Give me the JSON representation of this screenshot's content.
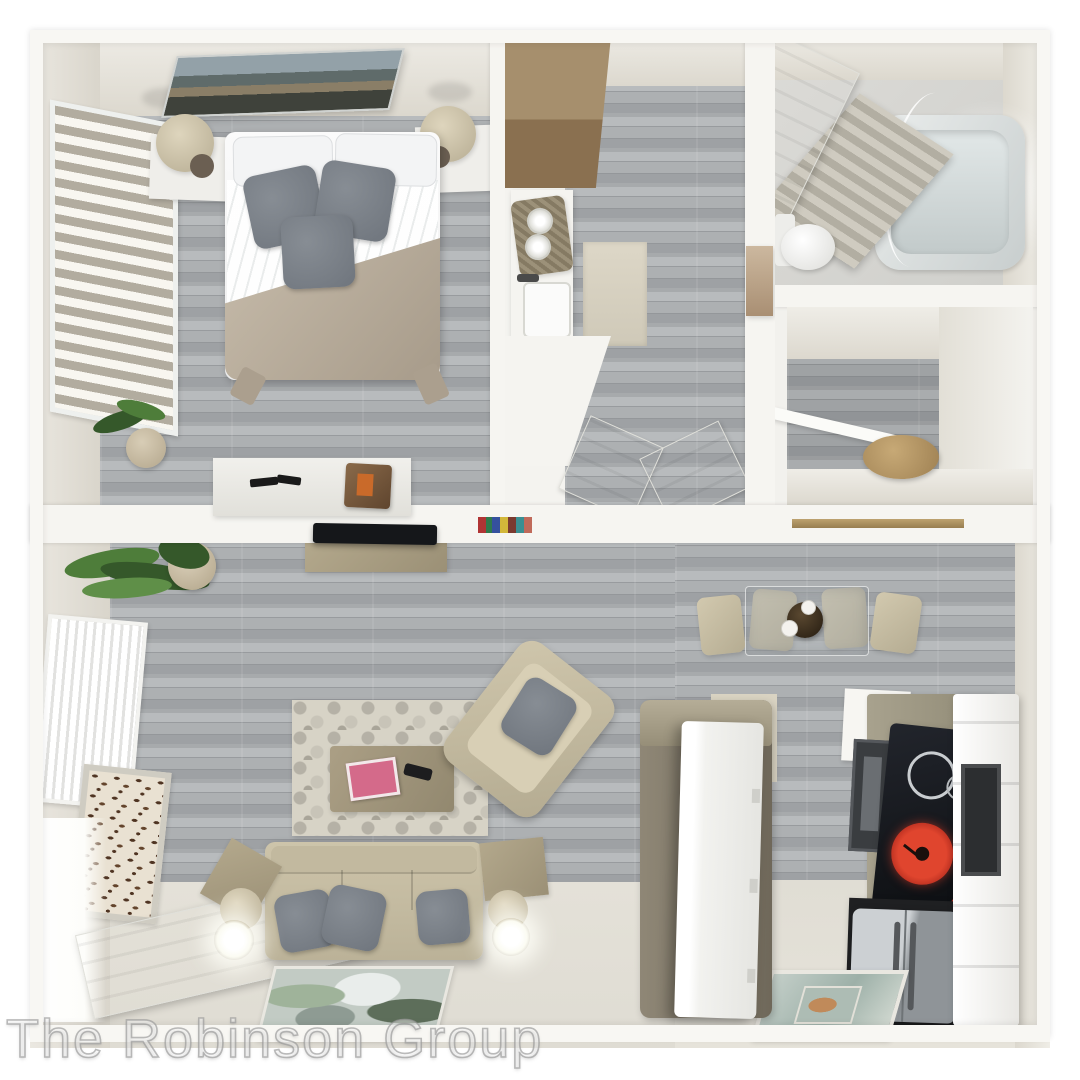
{
  "watermark": {
    "text": "The Robinson Group"
  },
  "scene": {
    "description": "3D top-down rendered floor plan of a one-bedroom apartment",
    "rooms": [
      {
        "name": "bedroom",
        "furniture": [
          "wall-art",
          "window-blinds",
          "nightstand-left",
          "lamp-left",
          "bed",
          "white-pillows",
          "gray-throw-pillows",
          "tan-blanket",
          "nightstand-right",
          "lamp-right",
          "potted-plant",
          "desk"
        ]
      },
      {
        "name": "laundry-closet",
        "furniture": [
          "wood-cabinet",
          "counter",
          "towel-tray",
          "sink"
        ]
      },
      {
        "name": "hallway",
        "furniture": [
          "runner-rug",
          "wall-painting",
          "open-door-left",
          "open-door-right"
        ]
      },
      {
        "name": "bathroom",
        "furniture": [
          "bathroom-door",
          "shower-curtain",
          "bathtub",
          "toilet"
        ]
      },
      {
        "name": "walk-in-closet",
        "furniture": [
          "shelves",
          "open-door",
          "basket"
        ]
      },
      {
        "name": "living-room",
        "furniture": [
          "hanging-plant",
          "potted-plant",
          "tv",
          "tv-console",
          "radiator",
          "leaf-artwork",
          "front-door",
          "area-rug",
          "coffee-table",
          "magazines",
          "remote-control",
          "armchair",
          "sofa",
          "sofa-pillows",
          "end-table-left",
          "floor-lamp-left",
          "end-table-right",
          "floor-lamp-right",
          "floor-painting"
        ]
      },
      {
        "name": "kitchen-dining",
        "furniture": [
          "dining-chairs",
          "glass-dining-table",
          "centerpiece-bowl",
          "island-partition",
          "island-door",
          "wall-cabinet",
          "microwave-oven",
          "cooktop",
          "red-burner",
          "wall-oven-column",
          "refrigerator",
          "kitchen-floor-mat",
          "wood-ledge",
          "book-row"
        ]
      }
    ]
  },
  "colors": {
    "wall_white": "#f6f5f1",
    "wall_beige": "#e5e2d9",
    "floor_gray": "#a7aaac",
    "floor_gray_dark": "#94979a",
    "floor_gray_light": "#b8bbbd",
    "carpet_beige": "#dfdcd3",
    "wood_light": "#a68f6d",
    "wood_dark": "#8a7050",
    "sofa_beige": "#c9c0a6",
    "pillow_gray": "#878d94",
    "pillow_gray_dark": "#6f757d",
    "blanket_tan": "#b9ad9c",
    "island_olive": "#837a6a",
    "counter_tan": "#a59e8a",
    "appliance_black": "#1f2022",
    "burner_red": "#c62828",
    "steel_light": "#ccd0d3",
    "steel_dark": "#8f9498",
    "plant_green": "#4e7d3a",
    "plant_green_dark": "#35582a",
    "rug_cream": "#d7d3c6",
    "rug_gray": "#b5b1a6",
    "watermark_stroke": "#9b9b9b"
  }
}
